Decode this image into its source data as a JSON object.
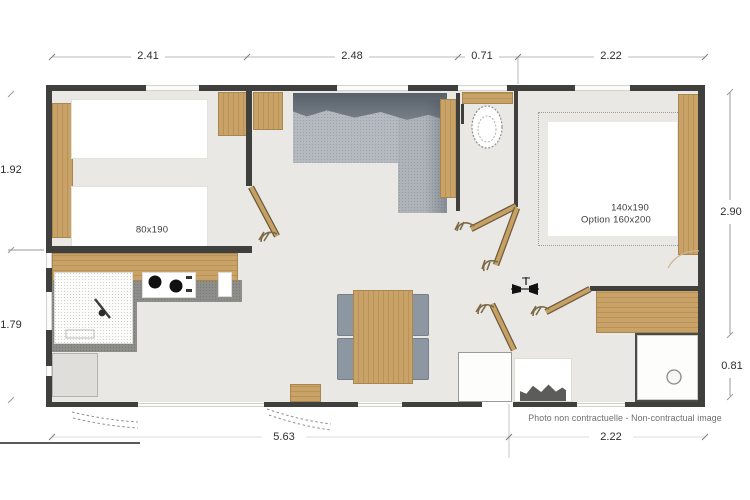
{
  "plan": {
    "type": "mobile-home floor plan",
    "dims": {
      "top": [
        "2.41",
        "2.48",
        "0.71",
        "2.22"
      ],
      "left": [
        "1.92",
        "1.79"
      ],
      "right": [
        "2.90",
        "0.81"
      ],
      "bottom": [
        "5.63",
        "2.22"
      ]
    },
    "rooms": {
      "small_bedroom_bed": "80x190",
      "master_bedroom_bed": "140x190",
      "master_bedroom_option": "Option 160x200"
    },
    "footer": {
      "note": "Photo non contractuelle - Non-contractual image"
    },
    "icons": {
      "doors": "door-leaf-with-hook-handle",
      "toilet": "toilet-bowl",
      "shower": "shower-tray-with-drain",
      "cooktop": "two-burner-cooktop",
      "sink": "kitchen-sink-with-faucet",
      "heater": "wall-heater-symbol",
      "steps": "entry-step-hatching"
    },
    "colors": {
      "wall": "#3f3f3d",
      "wood": "#c9a267",
      "floor": "#e9e8e4",
      "sofa": "#aab0b6",
      "chair": "#8d97a1",
      "dim_text": "#2e2e2e",
      "note_text": "#6e6e6e"
    }
  }
}
